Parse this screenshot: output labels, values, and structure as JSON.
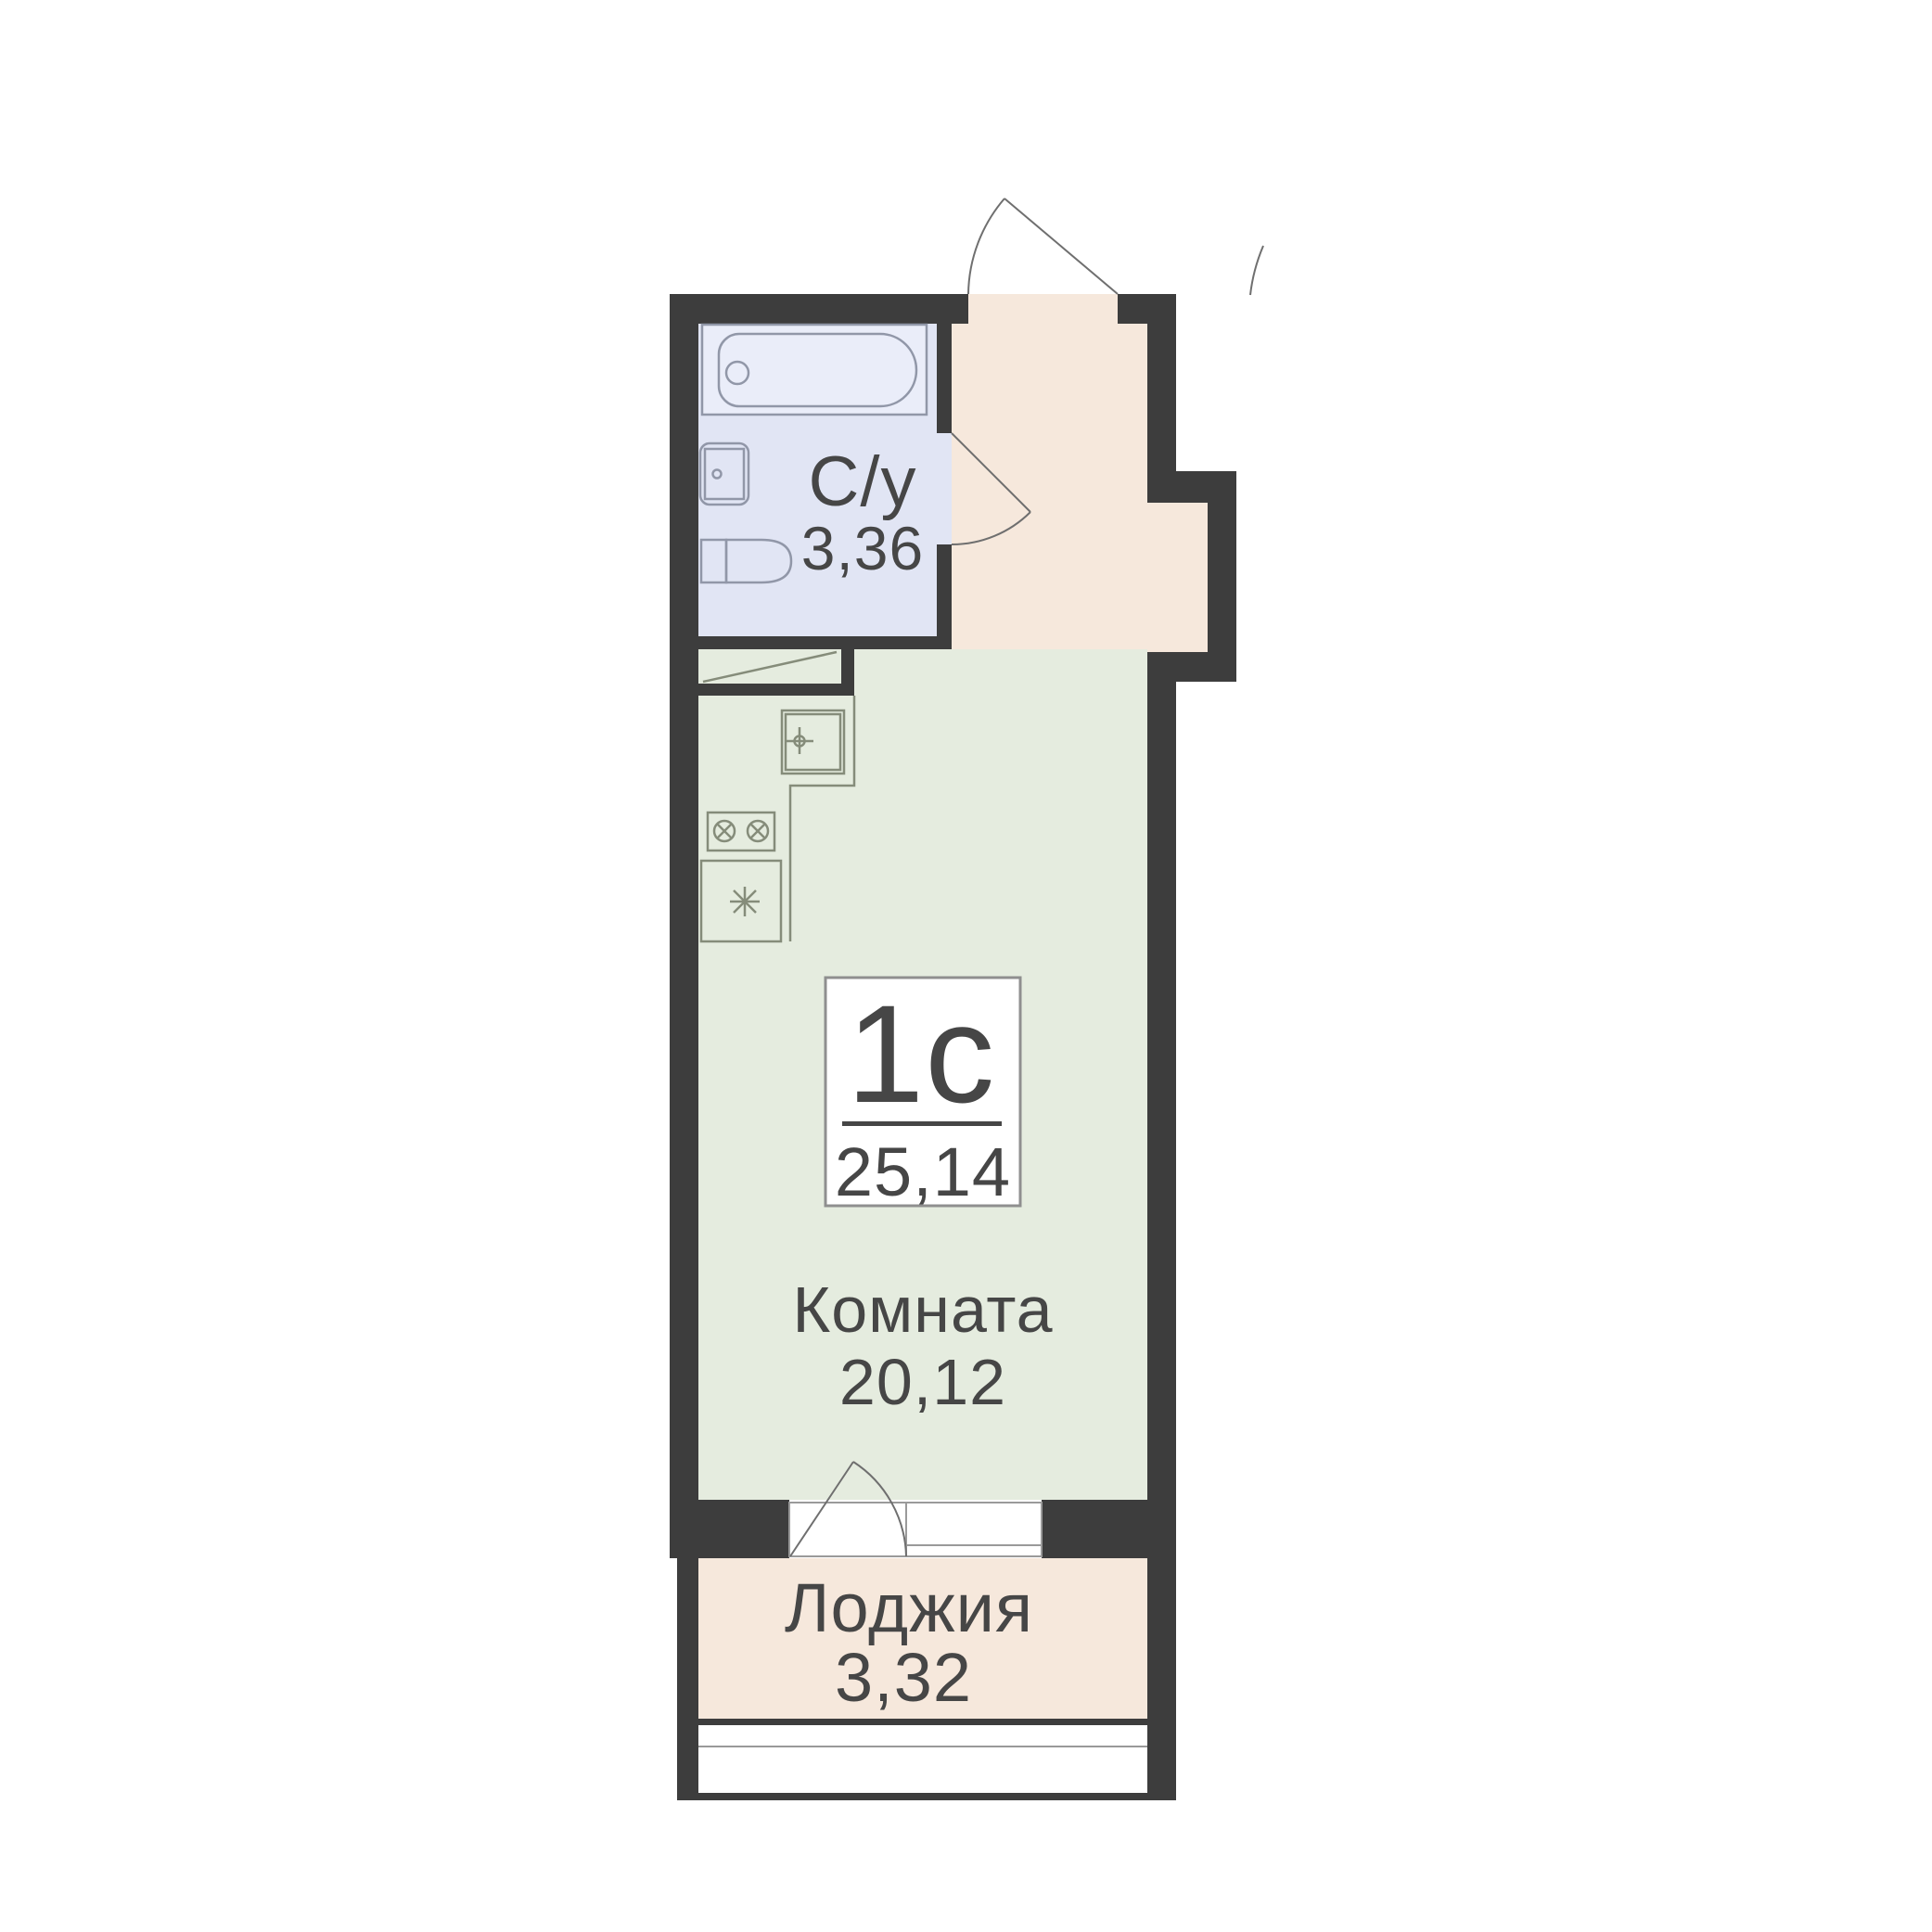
{
  "floor_plan": {
    "title": "Studio apartment floor plan",
    "unit_label": {
      "type": "1с",
      "total_area": "25,14"
    },
    "rooms": [
      {
        "id": "bathroom",
        "name": "С/у",
        "area": "3,36"
      },
      {
        "id": "room",
        "name": "Комната",
        "area": "20,12"
      },
      {
        "id": "loggia",
        "name": "Лоджия",
        "area": "3,32"
      }
    ],
    "colors": {
      "page": "#ffffff",
      "wall": "#3d3d3d",
      "bathroom": "#e1e5f4",
      "hall": "#f6e8dc",
      "room": "#e5ecdf",
      "loggia": "#f6e8dc",
      "bath_line": "#9197a8",
      "kitchen_line": "#858c7a",
      "door_line": "#6f6f6f",
      "glass_line": "#9a9a9a",
      "frame": "#8f8f8f",
      "text": "#464646"
    },
    "icons": [
      "bathtub-icon",
      "bathroom-sink-icon",
      "toilet-icon",
      "kitchen-sink-icon",
      "stove-icon",
      "fridge-icon",
      "wardrobe-niche-icon",
      "entrance-door-arc-icon",
      "bathroom-door-arc-icon",
      "balcony-door-arc-icon",
      "window-icon",
      "loggia-glazing-icon",
      "neighbor-door-arc-icon"
    ]
  }
}
